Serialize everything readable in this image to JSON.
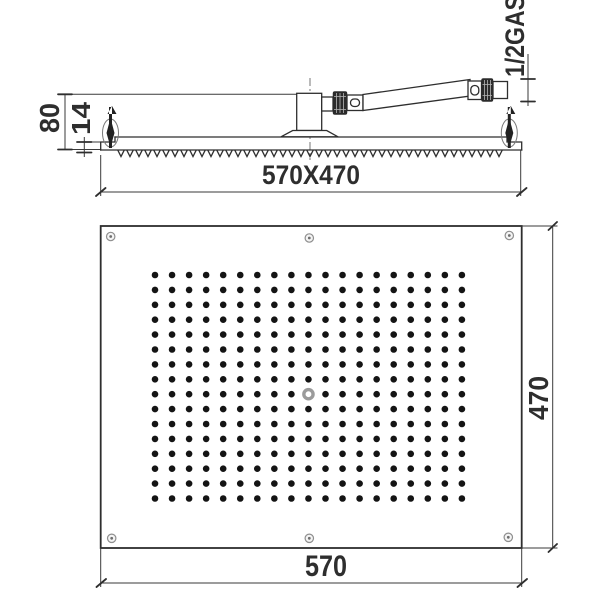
{
  "drawing_title": "Rectangular rain shower head technical drawing",
  "side_view": {
    "height_label": "80",
    "edge_thickness_label": "14",
    "panel_size_label": "570X470",
    "thread_label": "1/2GAS"
  },
  "face_view": {
    "width_label": "570",
    "height_label": "470",
    "screw_count": 6,
    "nozzle_grid": {
      "columns": 19,
      "rows": 16,
      "x_start": 155,
      "y_start": 275,
      "x_spacing": 17.05,
      "y_spacing": 14.9,
      "dot_radius": 3.3,
      "center_nozzle": {
        "column_index": 9,
        "row_index": 8,
        "radius": 4.6,
        "ring_width": 3.4
      }
    }
  },
  "colors": {
    "background": "#ffffff",
    "line": "#2e2e2e",
    "nozzle_dot": "#141414",
    "center_ring": "#9b9b9b",
    "screw_stroke": "#8f8f8f",
    "screw_dot": "#6f6f6f",
    "knurl_fill": "#2b2b2b"
  }
}
